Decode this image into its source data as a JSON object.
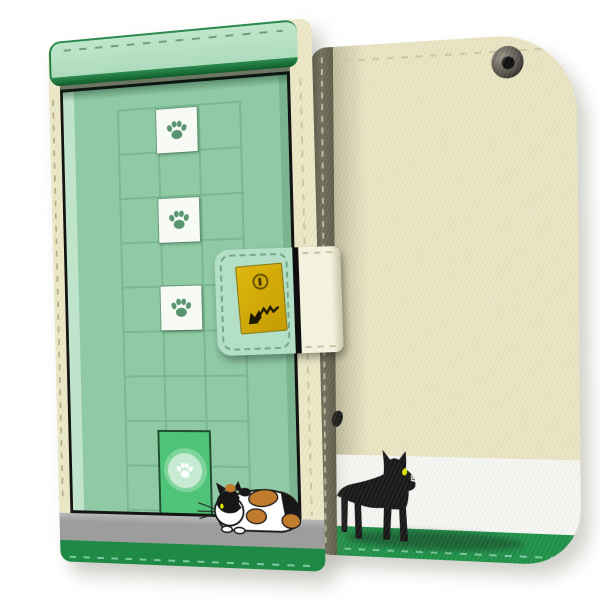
{
  "meta": {
    "type": "product-photo",
    "description": "Flip wallet smartphone case with cat design, shown closed from the front (left) and from the back (right)",
    "views": [
      "front cover closed",
      "back cover"
    ]
  },
  "colors": {
    "page_bg": "#ffffff",
    "case_cream": "#ece8c6",
    "rail_light": "#a9d8ba",
    "rail_deep": "#0f5c2c",
    "door_green": "#8fcaa4",
    "door_frame_light": "#bfe3cb",
    "grid_line": "#76b58e",
    "tile_white": "#f8faf5",
    "paw_green": "#57946f",
    "catdoor_green": "#4fc377",
    "catdoor_border": "#1f4f2e",
    "gray_band": "#9d9d9d",
    "front_base_green": "#1e8a45",
    "strap_green": "#b2dfc5",
    "strap_cream": "#f4f1de",
    "charm_yellow": "#c49c04",
    "back_cream": "#e9e4c2",
    "back_white": "#f6f6f3",
    "back_green": "#1f9148",
    "spine_olive": "#74715f",
    "stitch_cream": "#cfc9a4",
    "stitch_green": "#7cc9a0",
    "cat_black": "#171717",
    "cat_eye": "#dde000",
    "calico_orange": "#c07b2c",
    "calico_white": "#ffffff",
    "outline_black": "#1b1b1b"
  },
  "front_view": {
    "design": "green door with square grid pattern",
    "paw_tiles_count": 3,
    "cat_door": "small bright-green pet door with round paw emblem",
    "cat": "calico cat crouching beside the cat door",
    "bands": [
      "gray step band",
      "dark green base band with stitching"
    ]
  },
  "strap": {
    "parts": [
      "green stitched flap section",
      "cream band section"
    ],
    "charm": "yellow square tag with snap button and black cat doodle"
  },
  "back_view": {
    "camera": "metal eyelet hole at top right",
    "cat": "black cat with yellow eye walking on green base band",
    "extra": "black tail tip peeking past the spine",
    "bands": [
      "white band",
      "green stitched base band"
    ]
  }
}
